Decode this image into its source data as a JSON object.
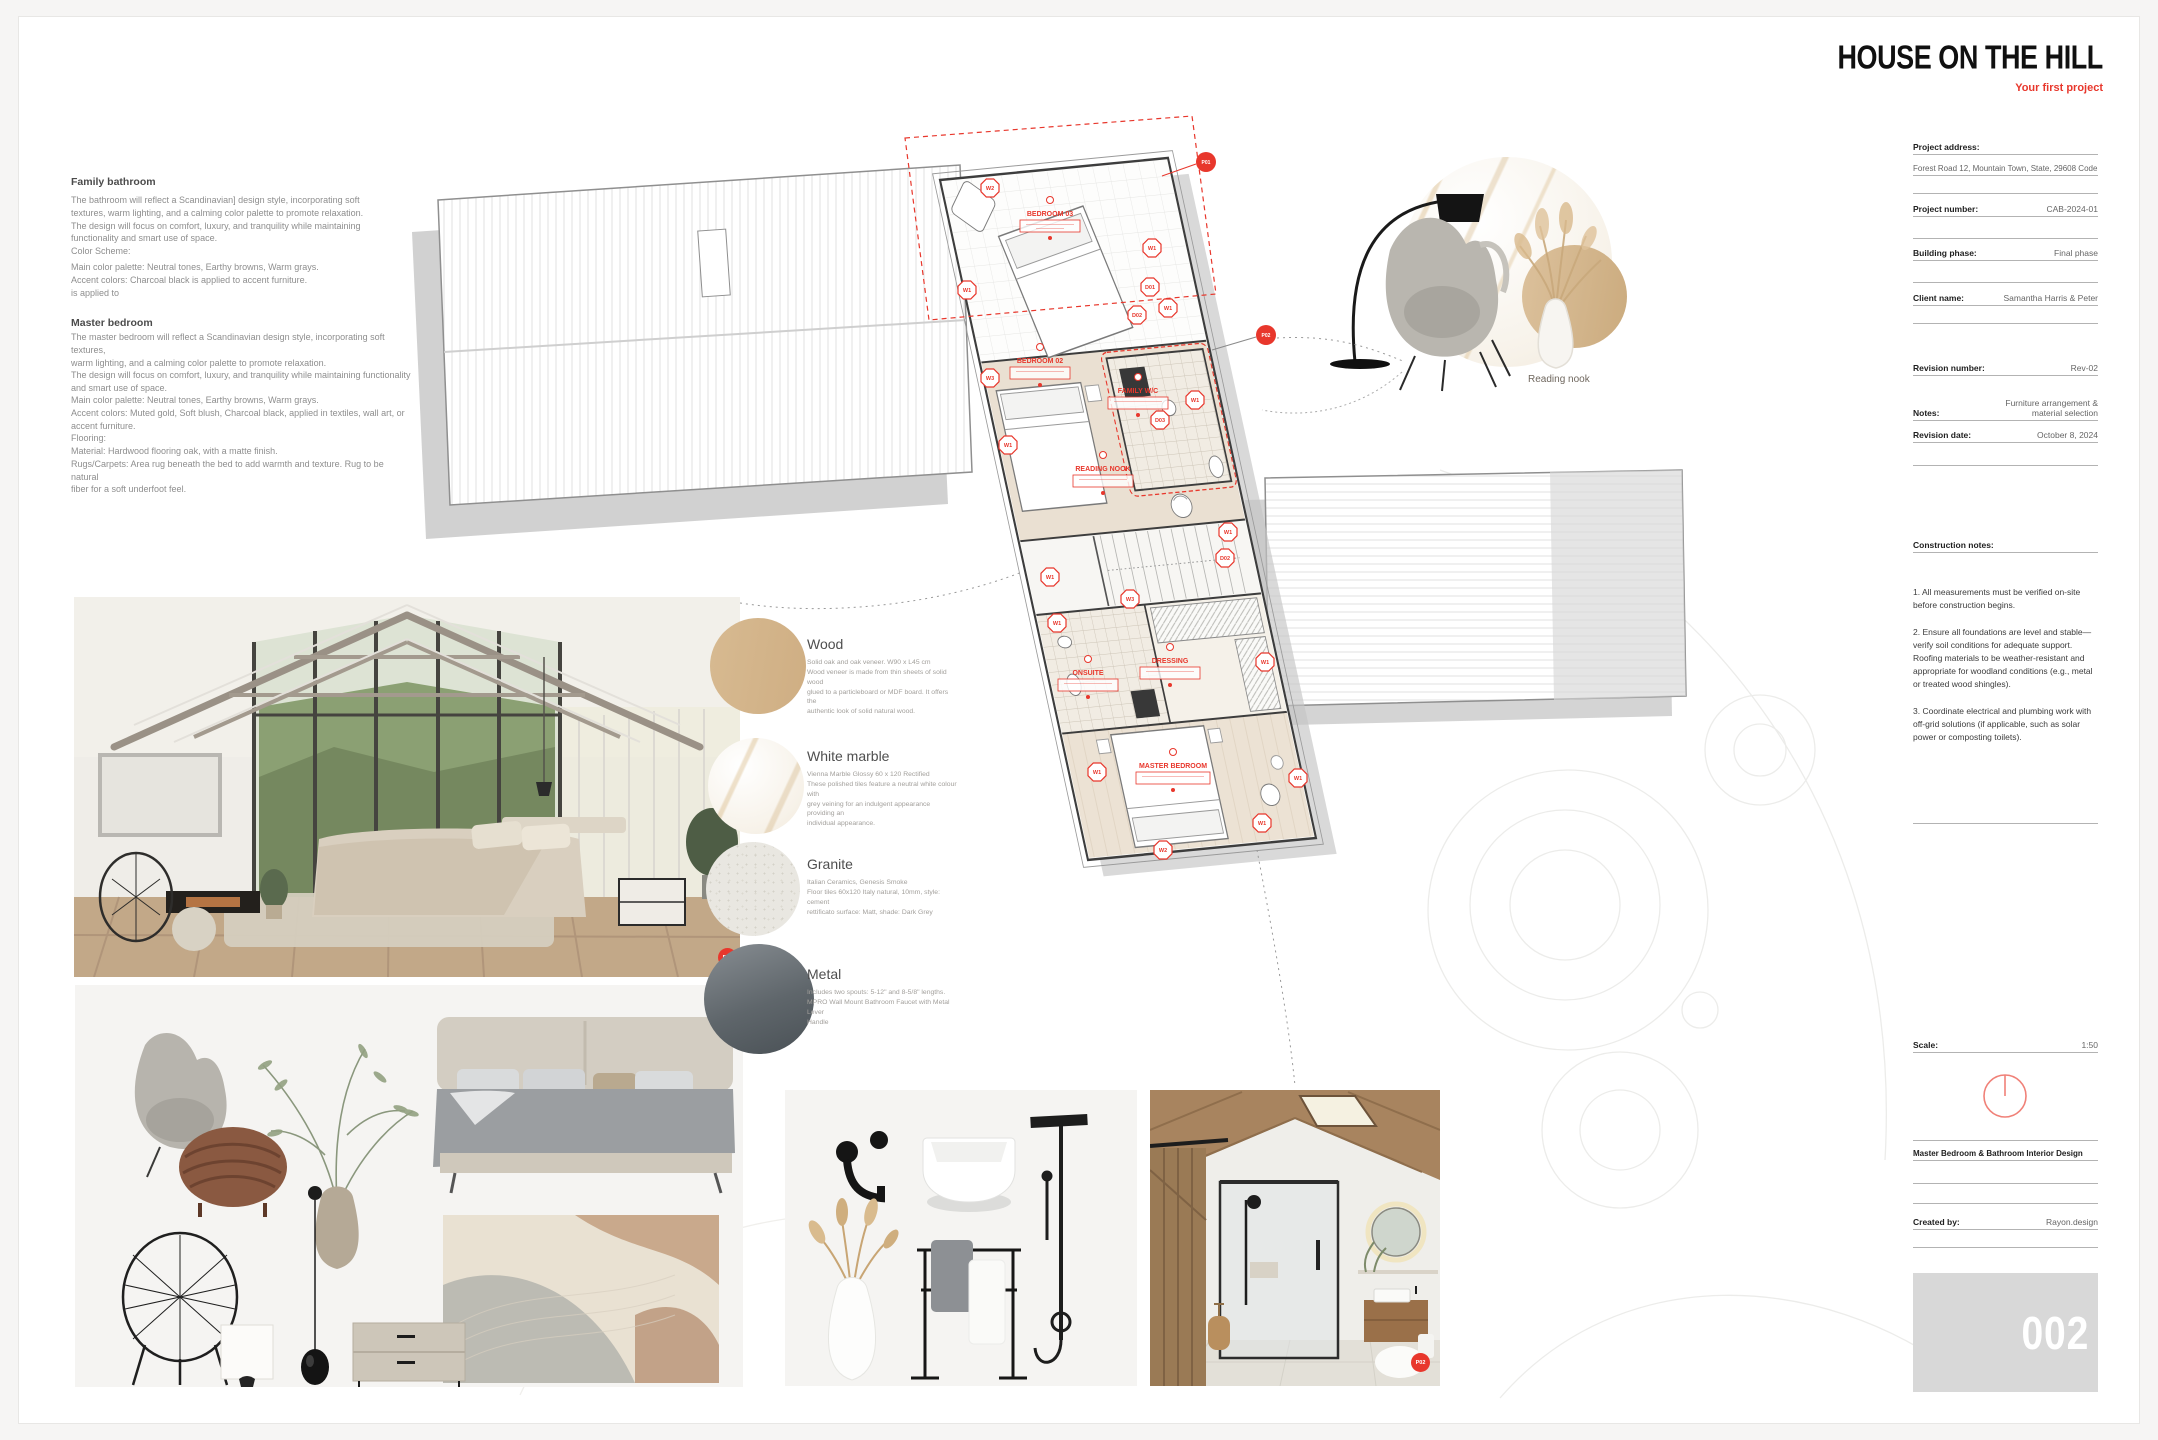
{
  "accent": "#e8372c",
  "header": {
    "title": "HOUSE ON THE HILL",
    "subtitle": "Your first project"
  },
  "titleblock": {
    "project_address_label": "Project address:",
    "project_address_value": "Forest Road 12, Mountain Town, State, 29608 Code",
    "project_number_label": "Project number:",
    "project_number_value": "CAB-2024-01",
    "building_phase_label": "Building phase:",
    "building_phase_value": "Final phase",
    "client_name_label": "Client name:",
    "client_name_value": "Samantha Harris & Peter",
    "revision_number_label": "Revision number:",
    "revision_number_value": "Rev-02",
    "notes_label": "Notes:",
    "notes_value": "Furniture arrangement & material selection",
    "revision_date_label": "Revision date:",
    "revision_date_value": "October 8, 2024",
    "construction_notes_label": "Construction notes:",
    "construction_notes": "1. All measurements must be verified on-site before construction begins.\n\n2. Ensure all foundations are level and stable—verify soil conditions for adequate support.\nRoofing materials to be weather-resistant and appropriate for woodland conditions (e.g., metal or treated wood shingles).\n\n3. Coordinate electrical and plumbing work with off-grid solutions (if applicable, such as solar power or composting toilets).",
    "scale_label": "Scale:",
    "scale_value": "1:50",
    "sheet_title": "Master Bedroom & Bathroom Interior Design",
    "created_by_label": "Created by:",
    "created_by_value": "Rayon.design",
    "page_number": "002"
  },
  "notes": {
    "family_bathroom_heading": "Family bathroom",
    "family_bathroom_p1": "The bathroom will reflect a Scandinavian] design style, incorporating soft\ntextures, warm lighting, and a calming color palette to promote relaxation.\nThe design will focus on comfort, luxury, and tranquility while maintaining\nfunctionality and smart use of space.\nColor Scheme:",
    "family_bathroom_p2": "Main color palette:  Neutral tones, Earthy browns, Warm grays.\nAccent colors: Charcoal black is applied to accent furniture.\n is applied to",
    "master_bedroom_heading": "Master bedroom",
    "master_bedroom_p1": "The master bedroom will reflect a Scandinavian design style, incorporating soft textures,\nwarm lighting, and a calming color palette to promote relaxation.\nThe design will focus on comfort, luxury, and tranquility while maintaining functionality\nand smart use of space.",
    "master_bedroom_p2": "Main color palette: Neutral tones, Earthy browns, Warm grays.\nAccent colors:  Muted gold, Soft blush, Charcoal black, applied in textiles, wall art, or\naccent furniture.\nFlooring:\nMaterial: Hardwood flooring oak, with a matte finish.\nRugs/Carpets: Area rug beneath the bed to add warmth and texture. Rug to be natural\nfiber for a soft underfoot feel."
  },
  "materials": [
    {
      "name": "Wood",
      "desc": "Solid oak and oak veneer. W90 x L45 cm\nWood veneer is made from thin sheets of solid wood\nglued to a particleboard or MDF board. It offers the\nauthentic look of solid natural wood.",
      "color": "#d5b88f"
    },
    {
      "name": "White marble",
      "desc": "Vienna Marble Glossy 60 x 120 Rectified\nThese polished tiles feature a neutral white colour with\ngrey veining for an indulgent appearance providing an\nindividual appearance.",
      "color": "#f6f1e8"
    },
    {
      "name": "Granite",
      "desc": "Italian Ceramics, Genesis Smoke\nFloor tiles 60x120 Italy natural, 10mm, style: cement\nrettificato surface: Matt, shade: Dark Grey",
      "color": "#e9e7e1"
    },
    {
      "name": "Metal",
      "desc": "Includes two spouts: 5-12\" and 8-5/8\" lengths.\nMPRO Wall Mount Bathroom Faucet with Metal Lever\nHandle",
      "color": "#5f666b"
    }
  ],
  "plan": {
    "rooms": [
      "BEDROOM 03",
      "BEDROOM 02",
      "FAMILY W/C",
      "READING NOOK",
      "ONSUITE",
      "DRESSING",
      "MASTER BEDROOM"
    ],
    "window_tags": [
      "W1",
      "W2",
      "W3"
    ],
    "door_tags": [
      "D01",
      "D02",
      "D03"
    ],
    "markers": [
      "P01",
      "P02"
    ],
    "caption": "Reading nook"
  }
}
